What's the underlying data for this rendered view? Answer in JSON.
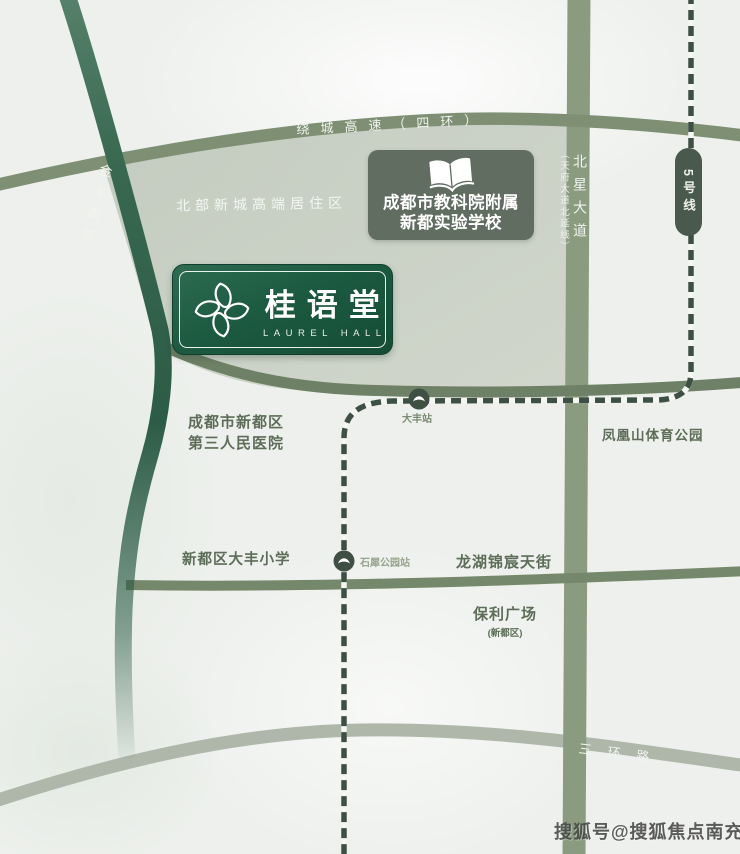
{
  "map": {
    "roads": {
      "ring_expressway": "绕城高速（四环）",
      "jinfeng_viaduct": "金丰高架",
      "beixing_avenue": "北星大道",
      "beixing_avenue_sub": "（天府大道北延线）",
      "third_ring": "三环路"
    },
    "metro": {
      "line_label": "5号线",
      "station_dafeng": "大丰站",
      "station_shixi": "石犀公园站"
    },
    "zones": {
      "residential": "北部新城高端居住区"
    },
    "pois": {
      "school_line1": "成都市教科院附属",
      "school_line2": "新都实验学校",
      "hospital_line1": "成都市新都区",
      "hospital_line2": "第三人民医院",
      "phoenix_park": "凤凰山体育公园",
      "primary_school": "新都区大丰小学",
      "longfor_mall": "龙湖锦宸天街",
      "poly_plaza": "保利广场",
      "poly_plaza_sub": "(新都区)"
    },
    "logo": {
      "name_cn": "桂语堂",
      "name_en": "LAUREL HALL"
    },
    "watermark": "搜狐号@搜狐焦点南充站",
    "colors": {
      "brand_green_dark": "#1c5a41",
      "road_gray_green": "#7e8f74",
      "road_dark_green": "#2c5c47",
      "metro_dark": "#3e5045",
      "zone_fill": "#c5ccc0",
      "label_green": "#5d6d59",
      "background": "#edf0ec"
    }
  }
}
